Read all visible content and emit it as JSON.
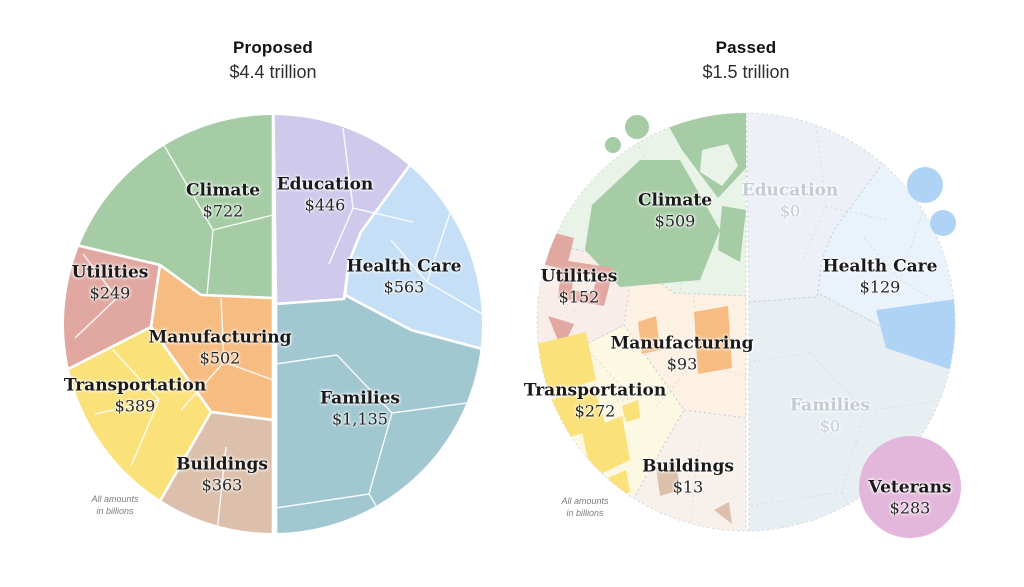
{
  "page": {
    "background": "#ffffff"
  },
  "charts": [
    {
      "title": "Proposed",
      "subtitle": "$4.4 trillion",
      "note": "All amounts\nin billions",
      "labels": [
        {
          "name": "Climate",
          "value": "$722"
        },
        {
          "name": "Education",
          "value": "$446"
        },
        {
          "name": "Health Care",
          "value": "$563"
        },
        {
          "name": "Utilities",
          "value": "$249"
        },
        {
          "name": "Manufacturing",
          "value": "$502"
        },
        {
          "name": "Transportation",
          "value": "$389"
        },
        {
          "name": "Families",
          "value": "$1,135"
        },
        {
          "name": "Buildings",
          "value": "$363"
        }
      ]
    },
    {
      "title": "Passed",
      "subtitle": "$1.5 trillion",
      "note": "All amounts\nin billions",
      "labels": [
        {
          "name": "Climate",
          "value": "$509"
        },
        {
          "name": "Education",
          "value": "$0"
        },
        {
          "name": "Health Care",
          "value": "$129"
        },
        {
          "name": "Utilities",
          "value": "$152"
        },
        {
          "name": "Manufacturing",
          "value": "$93"
        },
        {
          "name": "Transportation",
          "value": "$272"
        },
        {
          "name": "Families",
          "value": "$0"
        },
        {
          "name": "Buildings",
          "value": "$13"
        },
        {
          "name": "Veterans",
          "value": "$283"
        }
      ]
    }
  ],
  "palette": {
    "climate": "#a5cca5",
    "education": "#cfc9ec",
    "healthcare": "#c5dff6",
    "families": "#a1c7d1",
    "utilities": "#e1a8a1",
    "manufacturing": "#f7bc81",
    "transportation": "#fae179",
    "buildings": "#dcc0ab",
    "veterans": "#e3b7db",
    "healthcare_bubble": "#aed3f4",
    "faded_label": "#c5cad4",
    "pale_climate": "#e9f3e7",
    "pale_education": "#eef0f8",
    "pale_healthcare": "#eaf2fb",
    "pale_families": "#e8eff3",
    "pale_utilities": "#f9edea",
    "pale_manufacturing": "#fdf1e4",
    "pale_transportation": "#fcf8e2",
    "pale_buildings": "#f8f1eb"
  },
  "chart_data": [
    {
      "type": "pie",
      "variant": "voronoi-treemap-circle",
      "title": "Proposed",
      "subtitle": "$4.4 trillion",
      "unit": "billions of dollars",
      "note": "All amounts in billions",
      "categories": [
        "Climate",
        "Education",
        "Health Care",
        "Utilities",
        "Manufacturing",
        "Transportation",
        "Families",
        "Buildings"
      ],
      "values": [
        722,
        446,
        563,
        249,
        502,
        389,
        1135,
        363
      ],
      "total": "$4.4 trillion",
      "legend_position": "in-chart-labels",
      "grid": false
    },
    {
      "type": "pie",
      "variant": "voronoi-treemap-circle-partial-fill",
      "title": "Passed",
      "subtitle": "$1.5 trillion",
      "unit": "billions of dollars",
      "note": "All amounts in billions",
      "categories": [
        "Climate",
        "Education",
        "Health Care",
        "Utilities",
        "Manufacturing",
        "Transportation",
        "Families",
        "Buildings",
        "Veterans"
      ],
      "values": [
        509,
        0,
        129,
        152,
        93,
        272,
        0,
        13,
        283
      ],
      "total": "$1.5 trillion",
      "legend_position": "in-chart-labels",
      "grid": false
    }
  ]
}
